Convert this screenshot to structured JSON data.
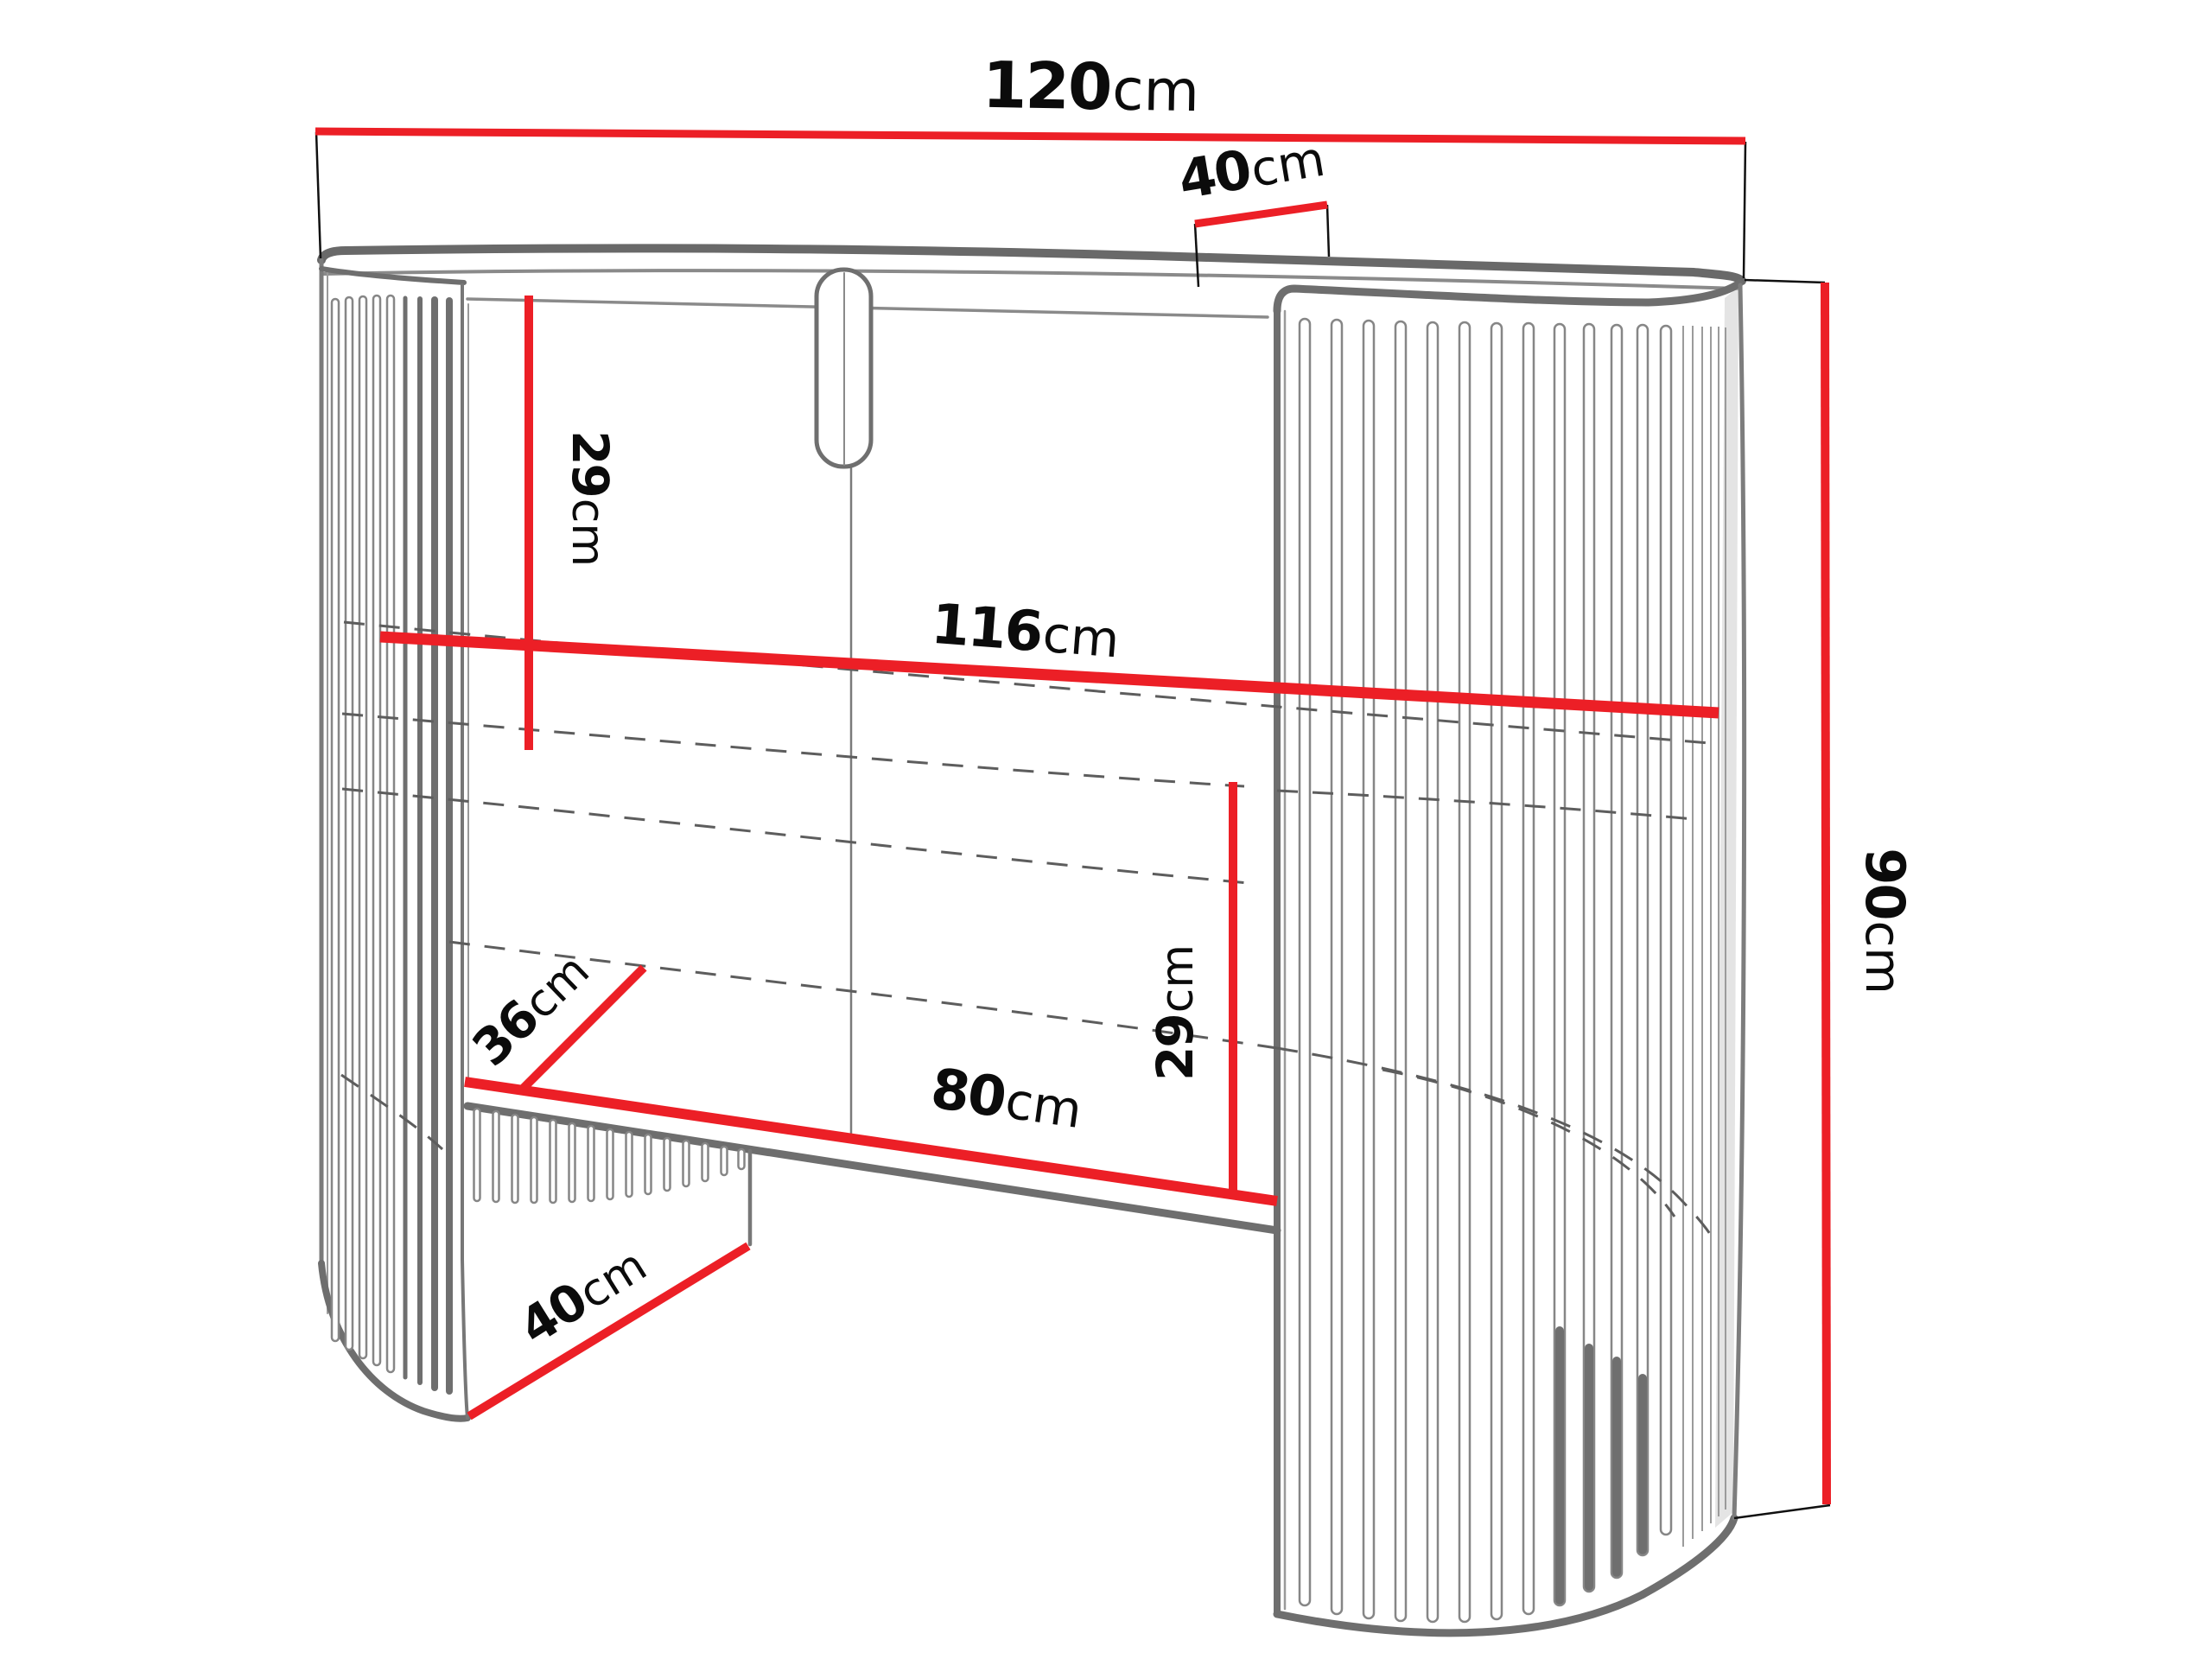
{
  "diagram": {
    "unit_suffix": "cm",
    "accent_red": "#ec1f26",
    "outline_gray": "#7a7a7a",
    "text_color": "#0b0b0b",
    "dimensions": {
      "top_width": {
        "num": "120",
        "unit": "cm"
      },
      "top_depth": {
        "num": "40",
        "unit": "cm"
      },
      "upper_clearance": {
        "num": "29",
        "unit": "cm"
      },
      "inner_width": {
        "num": "116",
        "unit": "cm"
      },
      "total_height": {
        "num": "90",
        "unit": "cm"
      },
      "shelf_depth": {
        "num": "36",
        "unit": "cm"
      },
      "lower_clearance": {
        "num": "29",
        "unit": "cm"
      },
      "opening_width": {
        "num": "80",
        "unit": "cm"
      },
      "base_depth": {
        "num": "40",
        "unit": "cm"
      }
    }
  }
}
